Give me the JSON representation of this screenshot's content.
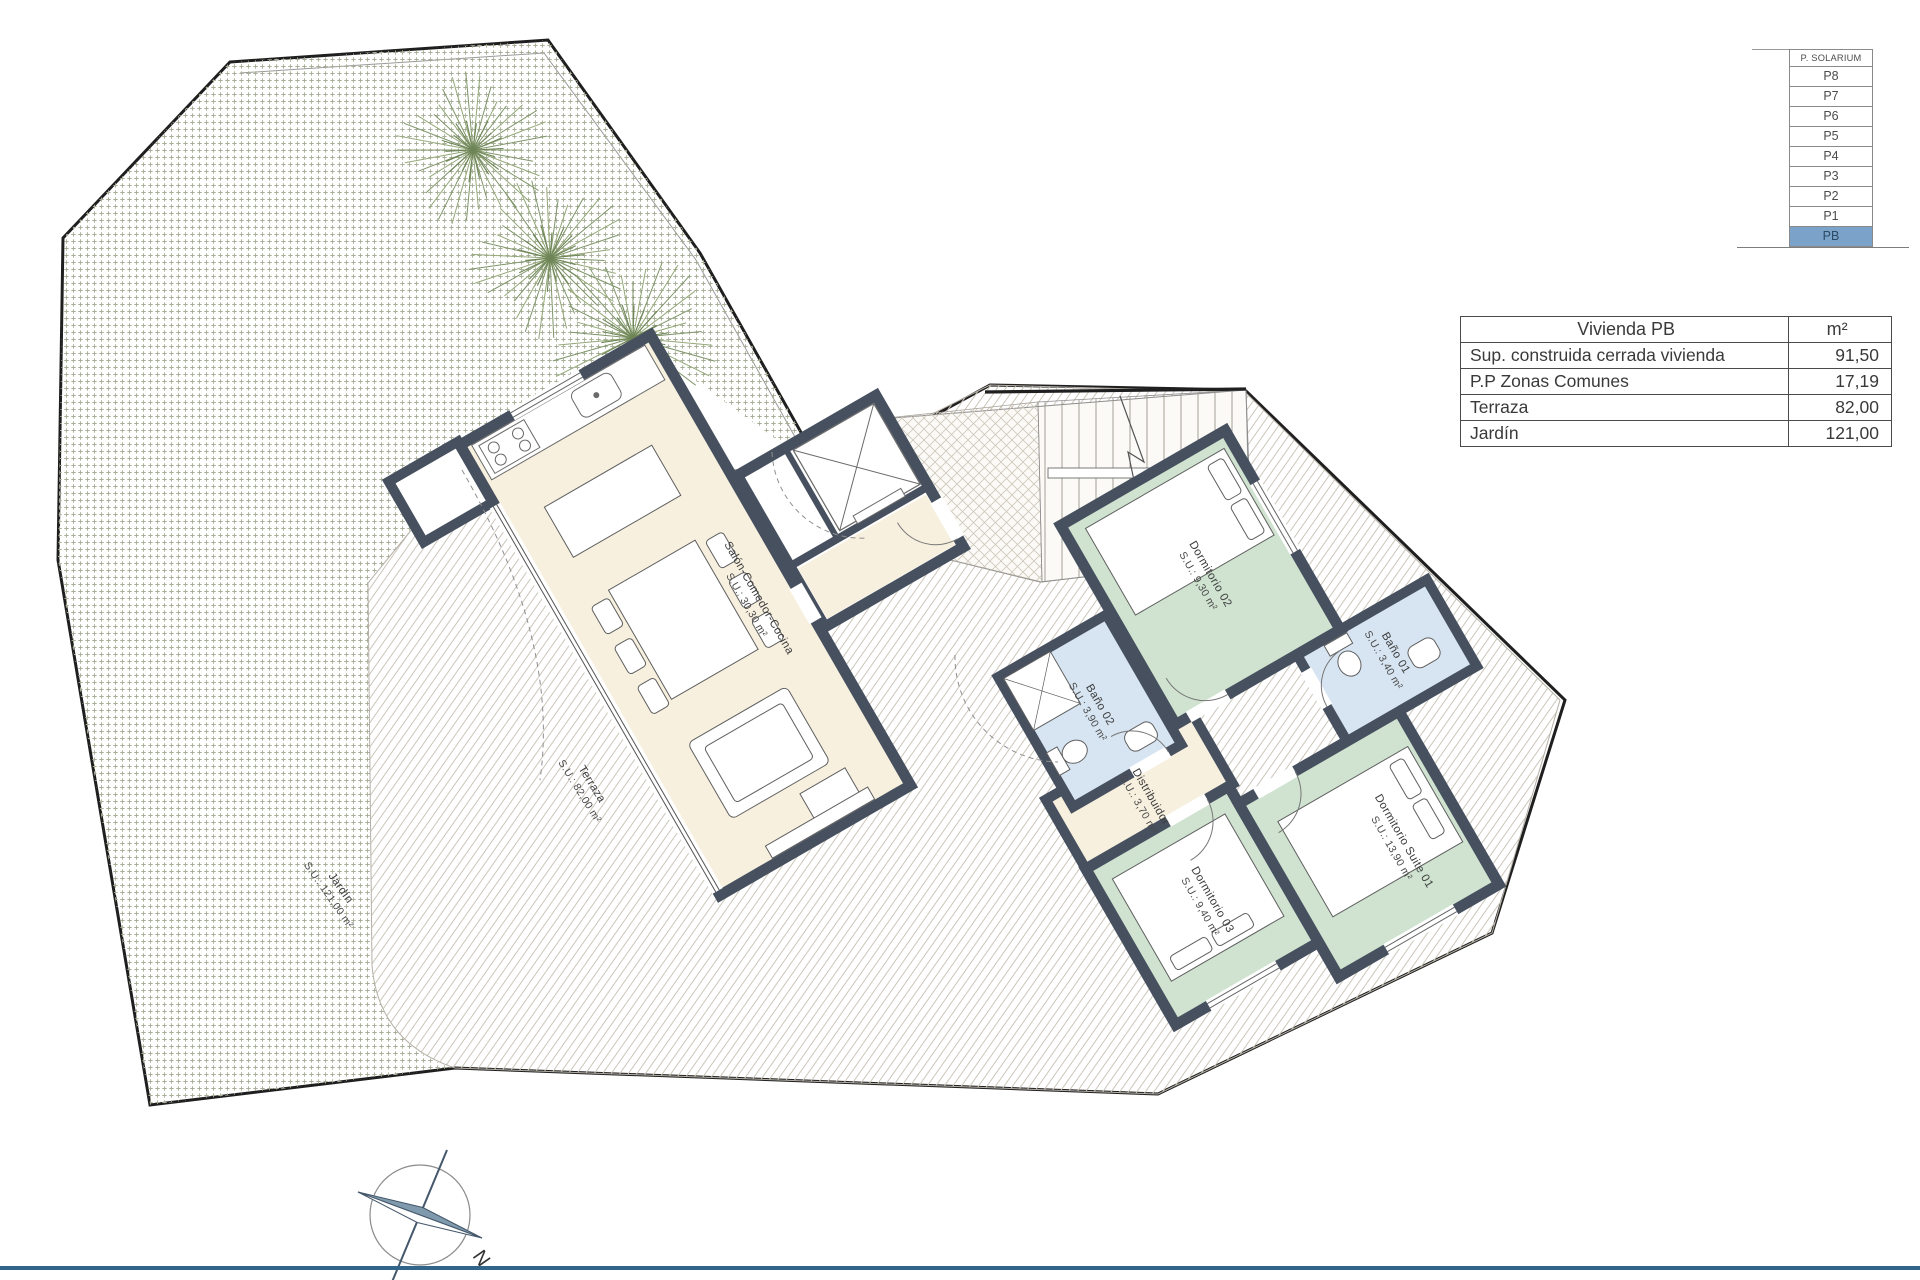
{
  "floor_selector": {
    "title": "P. SOLARIUM",
    "floors": [
      "P8",
      "P7",
      "P6",
      "P5",
      "P4",
      "P3",
      "P2",
      "P1",
      "PB"
    ],
    "selected": "PB",
    "highlight_color": "#7ba3c9"
  },
  "area_table": {
    "title": "Vivienda PB",
    "unit_header": "m²",
    "rows": [
      {
        "label": "Sup. construida cerrada vivienda",
        "value": "91,50"
      },
      {
        "label": "P.P Zonas Comunes",
        "value": "17,19"
      },
      {
        "label": "Terraza",
        "value": "82,00"
      },
      {
        "label": "Jardín",
        "value": "121,00"
      }
    ]
  },
  "rooms": {
    "salon": {
      "name": "Salón-Comedor-Cocina",
      "area": "S.U.: 30,30 m²"
    },
    "dormitorio02": {
      "name": "Dormitorio 02",
      "area": "S.U.: 9,30 m²"
    },
    "bano01": {
      "name": "Baño 01",
      "area": "S.U.: 3,40 m²"
    },
    "bano02": {
      "name": "Baño 02",
      "area": "S.U.: 3,90 m²"
    },
    "distribuidor": {
      "name": "Distribuidor",
      "area": "S.U.: 3,70 m²"
    },
    "dormitorio03": {
      "name": "Dormitorio 03",
      "area": "S.U.: 9,40 m²"
    },
    "suite01": {
      "name": "Dormitorio Suite 01",
      "area": "S.U.: 13,90 m²"
    },
    "terraza": {
      "name": "Terraza",
      "area": "S.U.: 82,00 m²"
    },
    "jardin": {
      "name": "Jardín",
      "area": "S.U.: 121,00 m²"
    }
  },
  "compass": {
    "north_label": "N"
  },
  "colors": {
    "wall": "#47505f",
    "living": "#f7f0df",
    "bedroom": "#cfe3d0",
    "bathroom": "#d7e5f2",
    "selected_floor": "#7ba3c9",
    "footer_line": "#33658a"
  }
}
